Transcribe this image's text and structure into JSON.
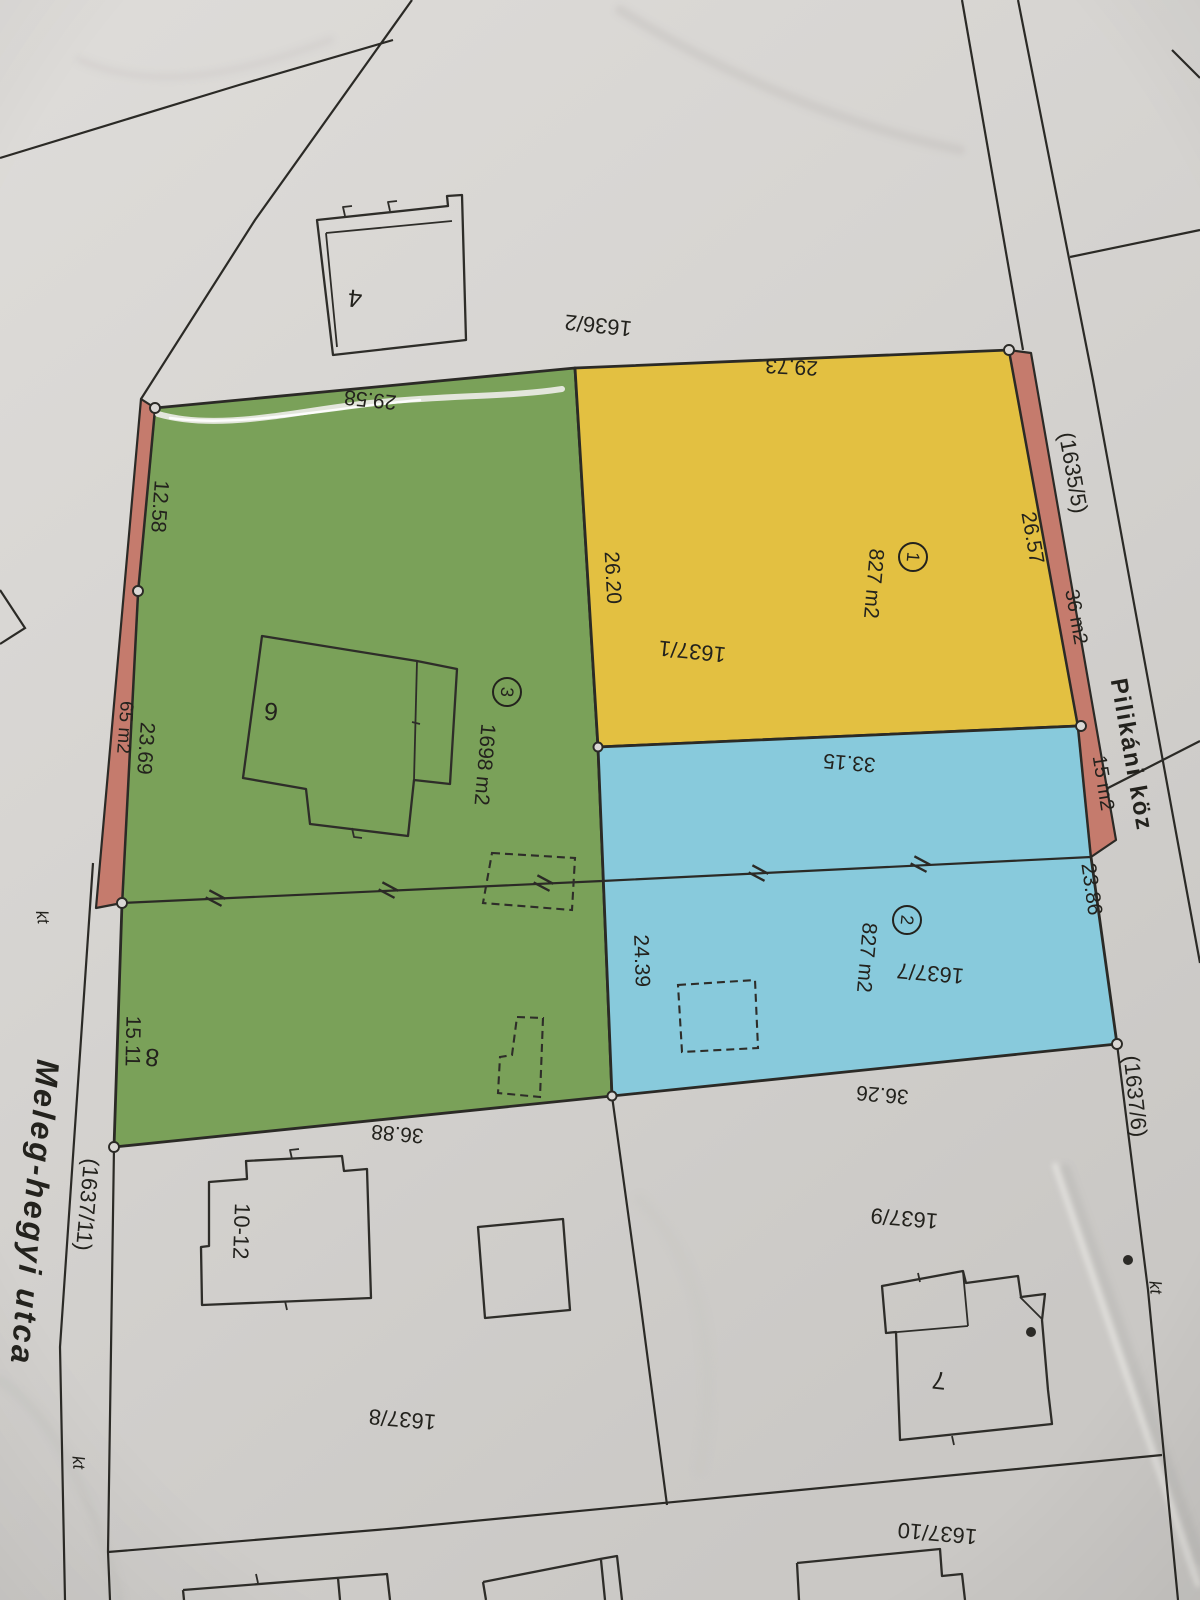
{
  "streets": {
    "meleg_hegyi": "Meleg-hegyi utca",
    "pilikani": "Pilikáni köz"
  },
  "parcels": {
    "yellow": {
      "id": "1637/1",
      "point": "1",
      "area": "827 m2"
    },
    "blue": {
      "id": "1637/7",
      "point": "2",
      "area": "827 m2"
    },
    "green": {
      "point": "3",
      "area": "1698 m2"
    }
  },
  "neighbor_parcels": {
    "n1636_2": "1636/2",
    "n1635_5": "(1635/5)",
    "n1637_6": "(1637/6)",
    "n1637_9": "1637/9",
    "n1637_8": "1637/8",
    "n1637_10": "1637/10",
    "n1637_11": "(1637/11)"
  },
  "strip_areas": {
    "right_upper": "36 m2",
    "right_lower": "15 m2",
    "left": "65 m2"
  },
  "house_numbers": {
    "h4": "4",
    "h6": "6",
    "h7": "7",
    "h8": "8",
    "h10_12": "10-12"
  },
  "dimensions": {
    "d29_58": "29.58",
    "d29_73": "29.73",
    "d26_57": "26.57",
    "d26_20": "26.20",
    "d33_15": "33.15",
    "d23_86": "23.86",
    "d24_39": "24.39",
    "d36_26": "36.26",
    "d36_88": "36.88",
    "d12_58": "12.58",
    "d23_69": "23.69",
    "d15_11": "15.11"
  },
  "misc": {
    "kt": "kt"
  },
  "colors": {
    "paper": "#d6d4d1",
    "yellow": "#e3c041",
    "green": "#7aa159",
    "blue": "#88cadc",
    "strip": "#c57b6d",
    "line": "#2b2a26",
    "text": "#23221d"
  }
}
